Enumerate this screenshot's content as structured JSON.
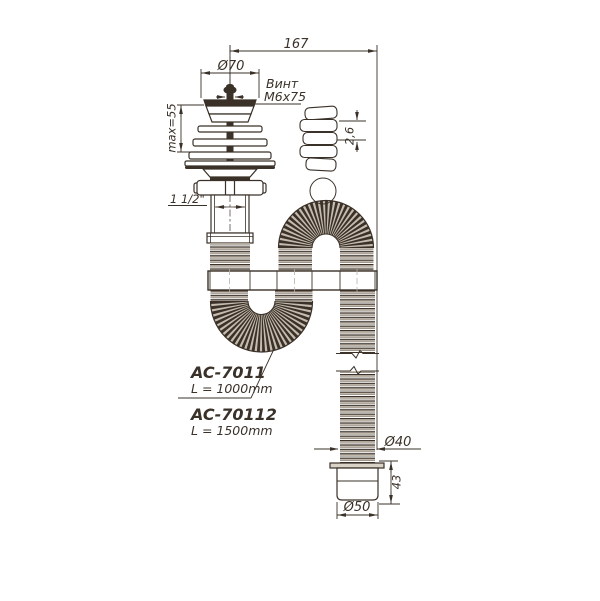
{
  "drawing": {
    "dims": {
      "overall_length": "167",
      "cap_diameter": "Ø70",
      "max_mount": "max=55",
      "thread": "1 1/2\"",
      "corrugation_pitch": "2,6",
      "hose_diameter": "Ø40",
      "outlet_height": "43",
      "outlet_diameter": "Ø50"
    },
    "screw": {
      "line1": "Винт",
      "line2": "М6х75"
    },
    "products": [
      {
        "model": "AC-7011",
        "length": "L = 1000mm"
      },
      {
        "model": "AC-70112",
        "length": "L = 1500mm"
      }
    ],
    "colors": {
      "line": "#3a3129",
      "corrugation": "#c5bcae",
      "background": "#ffffff"
    }
  }
}
